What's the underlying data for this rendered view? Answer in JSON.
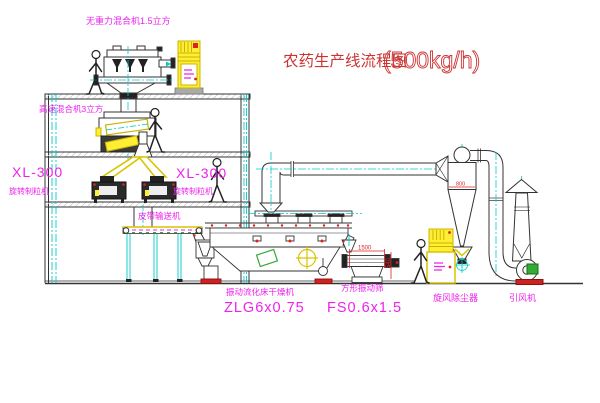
{
  "title": {
    "name": "农药生产线流程图",
    "capacity": "(500kg/h)"
  },
  "labels": {
    "gravity_mixer": "无重力混合机1.5立方",
    "high_speed_mixer": "高速混合机3立方",
    "granulator_left_model": "XL-300",
    "granulator_left_name": "旋转制粒机",
    "granulator_right_model": "XL-300",
    "granulator_right_name": "旋转制粒机",
    "belt_conveyor": "皮带输送机",
    "dryer_name": "振动流化床干燥机",
    "dryer_model": "ZLG6x0.75",
    "screen_name": "方形振动筛",
    "screen_model": "FS0.6x1.5",
    "cyclone": "旋风除尘器",
    "fan": "引风机"
  },
  "dimensions": {
    "screen_length": "1500",
    "screen_height": "540",
    "cyclone_inlet": "800"
  },
  "colors": {
    "label_magenta": "#ee22ee",
    "title_red": "#cc3333",
    "dim_red": "#dd2222",
    "centerline_cyan": "#00cccc",
    "machine_yellow": "#d8c400",
    "cabinet_yellow": "#ffee33",
    "accent_red": "#cc2222",
    "detail_green": "#33aa33",
    "line_dark": "#333333"
  }
}
